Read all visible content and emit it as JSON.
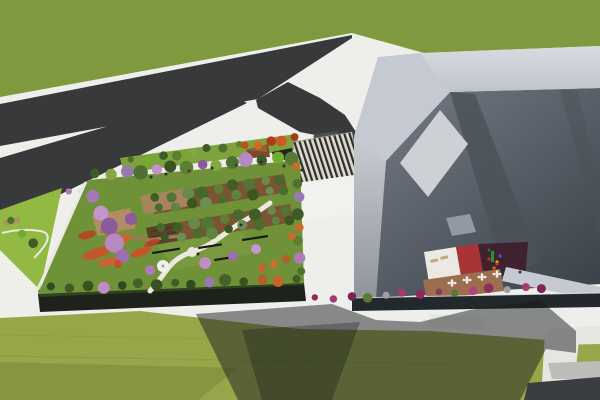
{
  "meta": {
    "title": "3D aerial architectural rendering: building complex with rooftop garden, roads and lawns",
    "canvas": {
      "w": 600,
      "h": 400
    }
  },
  "colors": {
    "pavement": "#eeeeea",
    "pavement_shade": "#d9d9d4",
    "grass_top": "#7f9a3e",
    "grass_bottom": "#97a649",
    "grass_bottom_dark": "#86953f",
    "mow_line": "#8a9a42",
    "road": "#37393b",
    "road_ramp": "#4c4f52",
    "lime": "#92b944",
    "plaza_green": "#7fa33c",
    "stripe_dark": "#2d2d2d",
    "stripe_light": "#ddd9c8",
    "stripe_edge": "#9b9b93",
    "canopy_dark": "#242424",
    "deck_brown": "#7a4a2e",
    "deck_brown_top": "#9c6038",
    "kiosk": "#f1f2ee",
    "garden_lawn": "#6f9138",
    "garden_lawn_light": "#7d9e42",
    "garden_bed": "#7b5434",
    "garden_bed_edge": "#5e3f26",
    "deck_tan": "#b08d62",
    "deck_tan2": "#a8845c",
    "pergola": "#5a4028",
    "pergola_slat": "#3e2c1c",
    "boardwalk": "#9c7a52",
    "flower_red": "#cb512b",
    "path_white": "#eae8e0",
    "facade_dark": "#1d231b",
    "hedge": "#31471f",
    "rim": "#e9e9e3",
    "bld_band": "#c5cad2",
    "bld_band_hi": "#d8dce1",
    "bld_band_lo": "#bfc4cc",
    "wall_hi": "#c9cdd2",
    "wall_lo": "#90959c",
    "roof_hi": "#757b84",
    "roof_lo": "#3e444c",
    "roof_facet": "#4b5159",
    "skylight": "#cdd1d6",
    "roof_panel": "#9aa0a8",
    "court_white": "#ece9e4",
    "court_red": "#a83434",
    "court_maroon": "#3f2130",
    "court_terrace": "#9c6e50",
    "lounger": "#c8a878",
    "street_band": "#23282c",
    "walk_white": "#e6e6e1",
    "walk_dim": "#bcbcb8",
    "lot_dark": "#3a3e41",
    "shadow": "rgba(22,27,32,0.48)",
    "shadow_core": "rgba(15,20,24,0.30)",
    "bench_dark": "#17191b",
    "table_top": "#f0efec",
    "table_dark": "#2a2a2e",
    "person_default": "#2b2e31",
    "gazebo_ring": "#c9c9c2",
    "gazebo_dot": "#a7a7a2"
  },
  "scene": {
    "tree_rows": [
      {
        "layer": "g-garden-trees",
        "name": "garden-top-tree-row",
        "x1": 96,
        "y1": 175,
        "x2": 292,
        "y2": 157,
        "n": 14,
        "r": 6,
        "colors": [
          "#3f5c28",
          "#86a844",
          "#9779ab",
          "#4f7030",
          "#c393c6",
          "#3a5424",
          "#5d7f33",
          "#8d5a9e",
          "#86a844",
          "#4f7030",
          "#b888c0",
          "#3f5c28",
          "#6fae2f",
          "#567a30"
        ]
      },
      {
        "layer": "g-garden-trees",
        "name": "garden-right-tree-row",
        "x1": 297,
        "y1": 168,
        "x2": 300,
        "y2": 272,
        "n": 8,
        "r": 5,
        "colors": [
          "#c76b2f",
          "#4f7030",
          "#9779ab",
          "#3f5c28",
          "#c76b2f",
          "#5d7f33",
          "#b07ab8",
          "#4f7030"
        ]
      },
      {
        "layer": "g-garden-trees",
        "name": "garden-bottom-tree-row",
        "x1": 52,
        "y1": 288,
        "x2": 296,
        "y2": 279,
        "n": 15,
        "r": 5,
        "colors": [
          "#2f4a20",
          "#3f5c28",
          "#35521f",
          "#c08cc4",
          "#2f4a20",
          "#446329",
          "#35521f",
          "#3f5c28",
          "#2f4a20",
          "#9779ab",
          "#446329",
          "#35521f",
          "#b85c28",
          "#c2652c",
          "#3f5c28"
        ]
      },
      {
        "layer": "g-garden-trees",
        "name": "garden-left-blossom-row",
        "x1": 94,
        "y1": 198,
        "x2": 122,
        "y2": 256,
        "n": 5,
        "r": 8,
        "colors": [
          "#a678b5",
          "#c395cd",
          "#8d5a9e",
          "#b888c0",
          "#9e6fae"
        ]
      },
      {
        "layer": "g-garden-trees",
        "name": "orchard-row-1a",
        "x1": 156,
        "y1": 199,
        "x2": 280,
        "y2": 179,
        "n": 9,
        "r": 5.5,
        "colors": [
          "#3e5e26",
          "#527436",
          "#68894a",
          "#46682c",
          "#5d7f33"
        ]
      },
      {
        "layer": "g-garden-trees",
        "name": "orchard-row-1b",
        "x1": 160,
        "y1": 209,
        "x2": 284,
        "y2": 189,
        "n": 9,
        "r": 5,
        "colors": [
          "#4a6b2e",
          "#5f8440",
          "#39571f",
          "#6b8f4e"
        ]
      },
      {
        "layer": "g-garden-trees",
        "name": "orchard-row-2a",
        "x1": 162,
        "y1": 229,
        "x2": 286,
        "y2": 209,
        "n": 9,
        "r": 5.5,
        "colors": [
          "#46682c",
          "#3e5e26",
          "#68894a",
          "#527436",
          "#5d7f33"
        ]
      },
      {
        "layer": "g-garden-trees",
        "name": "orchard-row-2b",
        "x1": 166,
        "y1": 239,
        "x2": 290,
        "y2": 219,
        "n": 9,
        "r": 5,
        "colors": [
          "#39571f",
          "#6b8f4e",
          "#4a6b2e",
          "#5f8440"
        ]
      },
      {
        "layer": "g-plaza-trees",
        "name": "plaza-green-tree-row",
        "x1": 132,
        "y1": 161,
        "x2": 238,
        "y2": 145,
        "n": 8,
        "r": 4,
        "colors": [
          "#4f7030",
          "#6fae2f",
          "#3f5c28",
          "#5d7f33",
          "#86a844",
          "#3f5c28",
          "#4f7030",
          "#5d7f33"
        ]
      },
      {
        "layer": "g-plaza-trees",
        "name": "plaza-orange-tree-row",
        "x1": 246,
        "y1": 147,
        "x2": 294,
        "y2": 137,
        "n": 5,
        "r": 4.5,
        "colors": [
          "#c44f1e",
          "#d2691e",
          "#b03a1a",
          "#cc5a22",
          "#a83818"
        ]
      },
      {
        "layer": "g-plaza-trees",
        "name": "northwest-bush-row",
        "x1": 70,
        "y1": 193,
        "x2": 116,
        "y2": 183,
        "n": 5,
        "r": 4,
        "colors": [
          "#b07ab8",
          "#e3e3df",
          "#c08cc4",
          "#8d5a9e",
          "#d9a8d6"
        ]
      },
      {
        "layer": "g-lime-trees",
        "name": "lime-strip-tree-row",
        "x1": 12,
        "y1": 222,
        "x2": 32,
        "y2": 244,
        "n": 3,
        "r": 4.5,
        "colors": [
          "#4f7030",
          "#6fae2f",
          "#3f5c28"
        ]
      },
      {
        "layer": "g-bushes",
        "name": "street-bush-row",
        "x1": 316,
        "y1": 299,
        "x2": 542,
        "y2": 287,
        "n": 14,
        "r": 4,
        "colors": [
          "#8e2b5e",
          "#a23a6f",
          "#7c2554",
          "#5a7a33",
          "#9aa0a6",
          "#a23a6f",
          "#8e2b5e",
          "#86375f",
          "#5a7a33",
          "#b04478",
          "#8e2b5e",
          "#9aa0a6",
          "#a23a6f",
          "#7c2554"
        ]
      }
    ],
    "single_trees": [
      {
        "x": 205,
        "y": 263,
        "r": 6,
        "c": "#c08cc4"
      },
      {
        "x": 233,
        "y": 256,
        "r": 5,
        "c": "#a06cb0"
      },
      {
        "x": 256,
        "y": 249,
        "r": 5,
        "c": "#c795c9"
      },
      {
        "x": 150,
        "y": 270,
        "r": 5,
        "c": "#b07ab8"
      },
      {
        "x": 131,
        "y": 219,
        "r": 6,
        "c": "#8d5a9e"
      },
      {
        "x": 262,
        "y": 268,
        "r": 4,
        "c": "#c2652c"
      },
      {
        "x": 274,
        "y": 264,
        "r": 4,
        "c": "#cc7030"
      },
      {
        "x": 286,
        "y": 259,
        "r": 4,
        "c": "#b85c28"
      },
      {
        "x": 118,
        "y": 264,
        "r": 4,
        "c": "#c84e2a"
      },
      {
        "x": 292,
        "y": 236,
        "r": 4,
        "c": "#c76b2f"
      }
    ],
    "flower_drifts": [
      [
        97,
        253,
        15,
        5,
        -18,
        "#cb512b"
      ],
      [
        119,
        241,
        13,
        5,
        -24,
        "#d2612f"
      ],
      [
        87,
        235,
        9,
        4,
        -12,
        "#b8431f"
      ],
      [
        141,
        252,
        11,
        4,
        -20,
        "#cb512b"
      ],
      [
        108,
        262,
        10,
        4,
        -15,
        "#d2612f"
      ],
      [
        152,
        243,
        8,
        3,
        -20,
        "#b8431f"
      ]
    ],
    "benches": [
      {
        "x": 152,
        "y": 252,
        "w": 28,
        "rot": -9
      },
      {
        "x": 198,
        "y": 247,
        "w": 24,
        "rot": -9
      },
      {
        "x": 242,
        "y": 239,
        "w": 26,
        "rot": -9
      },
      {
        "x": 214,
        "y": 259,
        "w": 16,
        "rot": -9
      }
    ],
    "tables": [
      {
        "x": 452,
        "y": 283,
        "dark": false
      },
      {
        "x": 467,
        "y": 280,
        "dark": false
      },
      {
        "x": 482,
        "y": 277,
        "dark": false
      },
      {
        "x": 497,
        "y": 274,
        "dark": false
      },
      {
        "x": 516,
        "y": 277,
        "dark": true
      }
    ],
    "loungers": [
      {
        "x": 430,
        "y": 260,
        "rot": -12
      },
      {
        "x": 440,
        "y": 257,
        "rot": -12
      }
    ],
    "playground_rects": [
      [
        491,
        251,
        3,
        11,
        "#2f8f35"
      ]
    ],
    "playground_dots": [
      [
        497,
        262,
        "#e0b020"
      ],
      [
        489,
        259,
        "#c03028"
      ],
      [
        500,
        256,
        "#3b5bd6"
      ],
      [
        494,
        268,
        "#d46a1a"
      ]
    ],
    "people": [
      [
        151,
        177
      ],
      [
        166,
        174
      ],
      [
        189,
        171,
        "#7a2020"
      ],
      [
        212,
        168
      ],
      [
        236,
        165,
        "#24415e"
      ],
      [
        261,
        162
      ],
      [
        284,
        166
      ],
      [
        302,
        170
      ],
      [
        198,
        254
      ],
      [
        241,
        225
      ],
      [
        489,
        250,
        "#1f7a2f"
      ],
      [
        497,
        264,
        "#c23b28"
      ],
      [
        520,
        272,
        "#2e3a55"
      ]
    ]
  }
}
